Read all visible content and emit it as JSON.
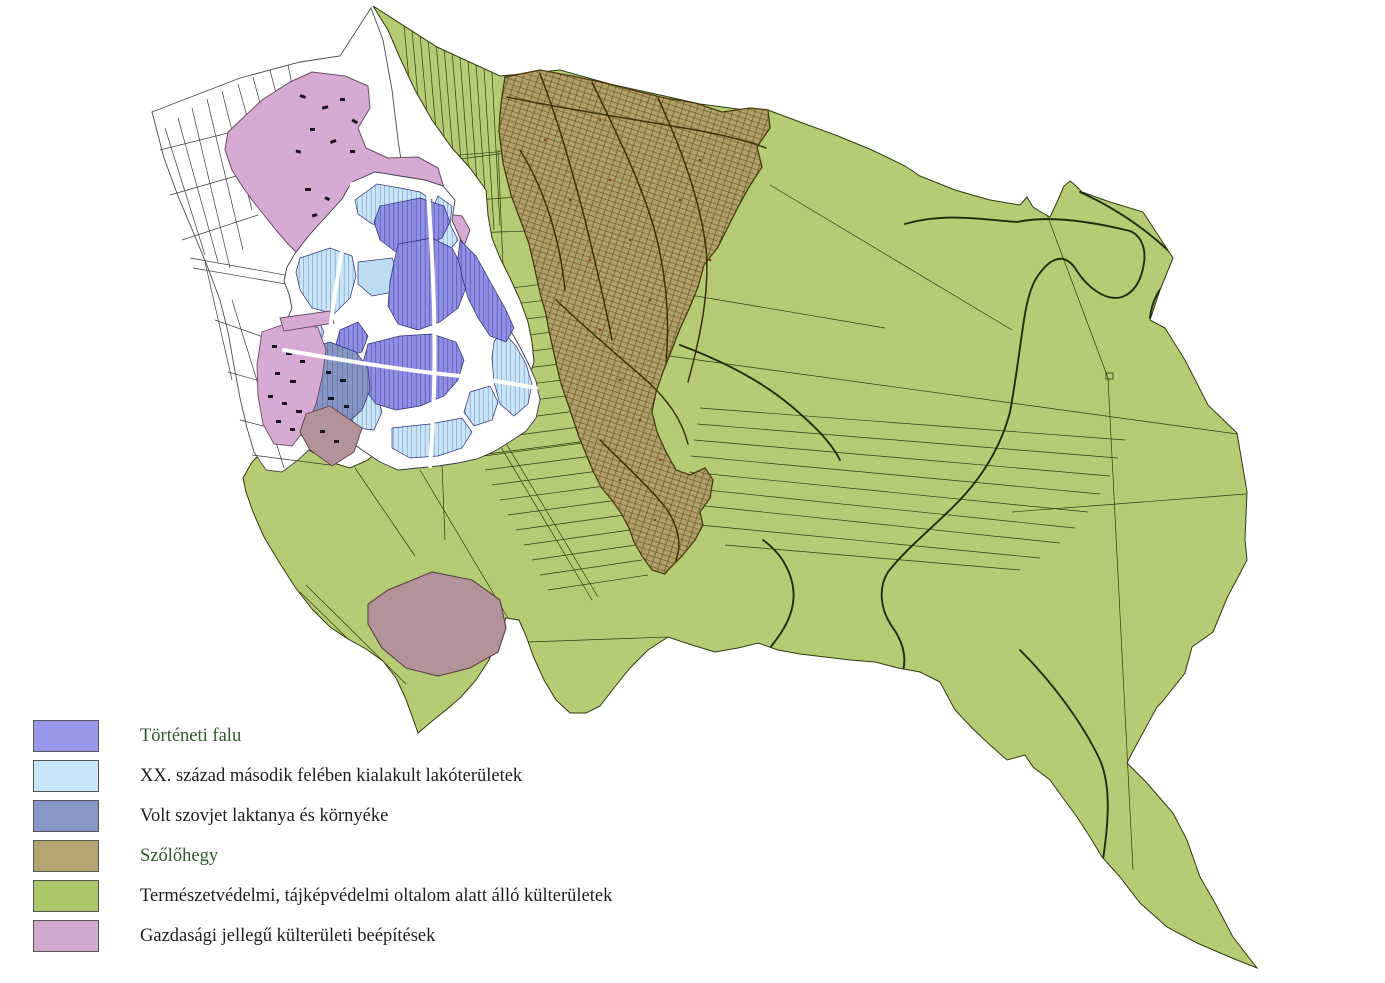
{
  "page": {
    "background": "#ffffff"
  },
  "legend": {
    "items": [
      {
        "id": "historic-village",
        "label": "Történeti falu",
        "color": "#9898ea",
        "label_color": "#2d5a27"
      },
      {
        "id": "modern-residential",
        "label": "XX. század második felében kialakult lakóterületek",
        "color": "#c8e4f8",
        "label_color": "#1c1c1c"
      },
      {
        "id": "soviet-barracks",
        "label": "Volt szovjet laktanya és környéke",
        "color": "#8896c6",
        "label_color": "#1c1c1c"
      },
      {
        "id": "vineyard-hill",
        "label": "Szőlőhegy",
        "color": "#b4a470",
        "label_color": "#2d5a27"
      },
      {
        "id": "protected-outskirts",
        "label": "Természetvédelmi, tájképvédelmi oltalom alatt álló külterületek",
        "color": "#abc869",
        "label_color": "#1c1c1c"
      },
      {
        "id": "economic-developments",
        "label": "Gazdasági jellegű külterületi beépítések",
        "color": "#d4a9d0",
        "label_color": "#1c1c1c"
      }
    ]
  },
  "map": {
    "description": "Land-use map of a village and its outskirts",
    "regions": [
      "historic-village-core",
      "modern-residential-areas",
      "former-soviet-barracks",
      "vineyard-hill",
      "protected-outskirts",
      "economic-outskirt-developments",
      "unclassified-parcels"
    ],
    "colors": {
      "green": "#b5cc74",
      "greenline": "#2f3a10",
      "vineyard": "#b1a168",
      "vineline": "#4a3a10",
      "vineroad": "#3e3008",
      "purple": "#9090e6",
      "purpleline": "#2c2c7a",
      "lightblue": "#c9e5f7",
      "lightblueline": "#4a6f9e",
      "pond": "#bcdcf2",
      "slate": "#8795c5",
      "slateline": "#2f3f6e",
      "pink": "#d6aad2",
      "mauve": "#b2939c",
      "outline": "#3b3b3b",
      "stream": "#1f2d08",
      "building": "#15151c",
      "reddot": "#8a3c28",
      "white": "#ffffff"
    }
  }
}
